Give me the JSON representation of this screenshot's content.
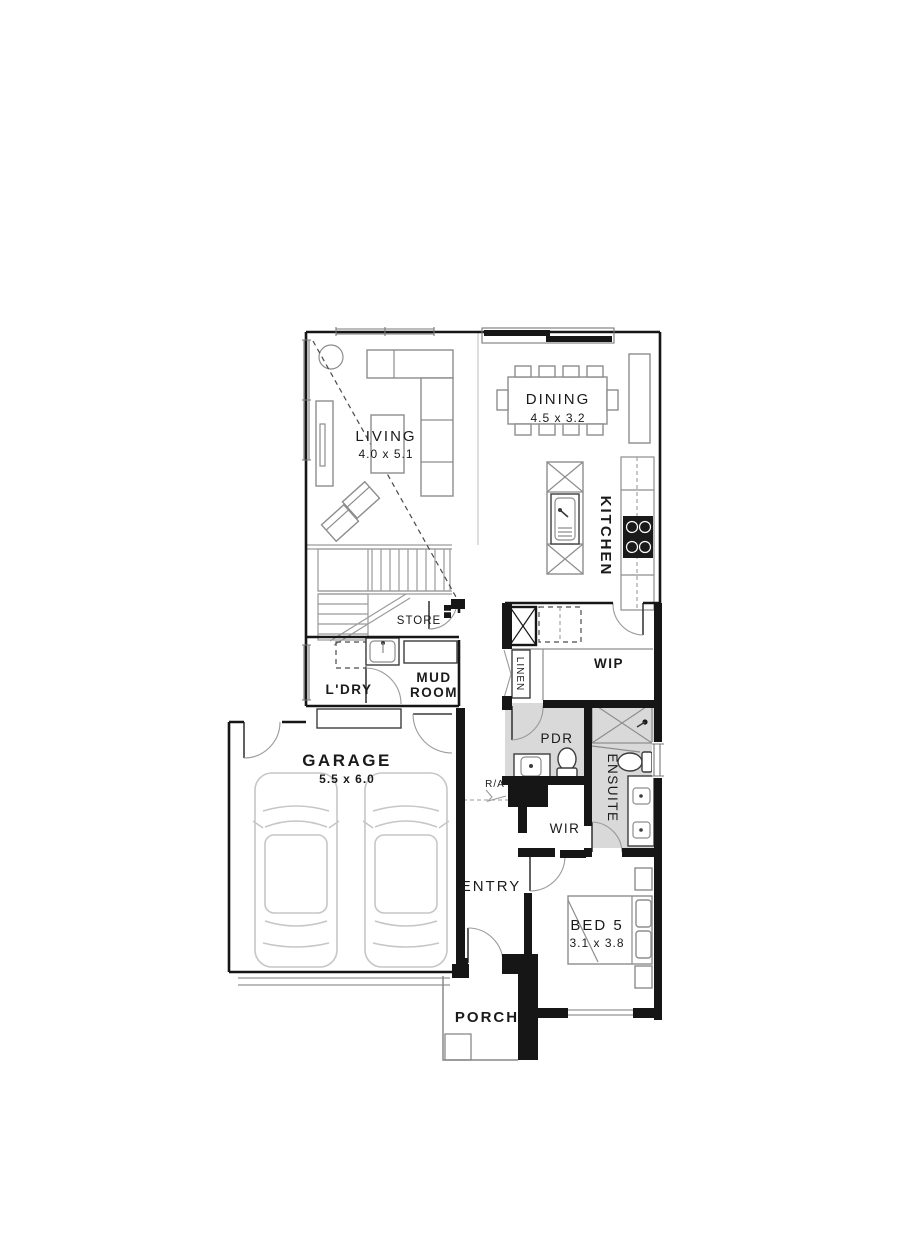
{
  "drawing": {
    "type": "residential floor plan",
    "level": "ground floor"
  },
  "colors": {
    "wall": "#161616",
    "tile": "#d9d9d9",
    "line": "#8f8f8f",
    "furniture": "#8d8d8d",
    "car": "#c6c6c6",
    "text": "#1a1a1a",
    "dash": "#4a4a4a"
  },
  "rooms": {
    "living": {
      "label": "LIVING",
      "dim": "4.0 x 5.1"
    },
    "dining": {
      "label": "DINING",
      "dim": "4.5 x 3.2"
    },
    "kitchen": {
      "label": "KITCHEN"
    },
    "store": {
      "label": "STORE"
    },
    "laundry": {
      "label": "L'DRY"
    },
    "mudroom": {
      "line1": "MUD",
      "line2": "ROOM"
    },
    "linen": {
      "label": "LINEN"
    },
    "wip": {
      "label": "WIP"
    },
    "pdr": {
      "label": "PDR"
    },
    "ensuite": {
      "label": "ENSUITE"
    },
    "wir": {
      "label": "WIR"
    },
    "return_air": {
      "label": "R/A"
    },
    "garage": {
      "label": "GARAGE",
      "dim": "5.5 x 6.0"
    },
    "entry": {
      "label": "ENTRY"
    },
    "bed5": {
      "label": "BED 5",
      "dim": "3.1 x 3.8"
    },
    "porch": {
      "label": "PORCH"
    }
  }
}
